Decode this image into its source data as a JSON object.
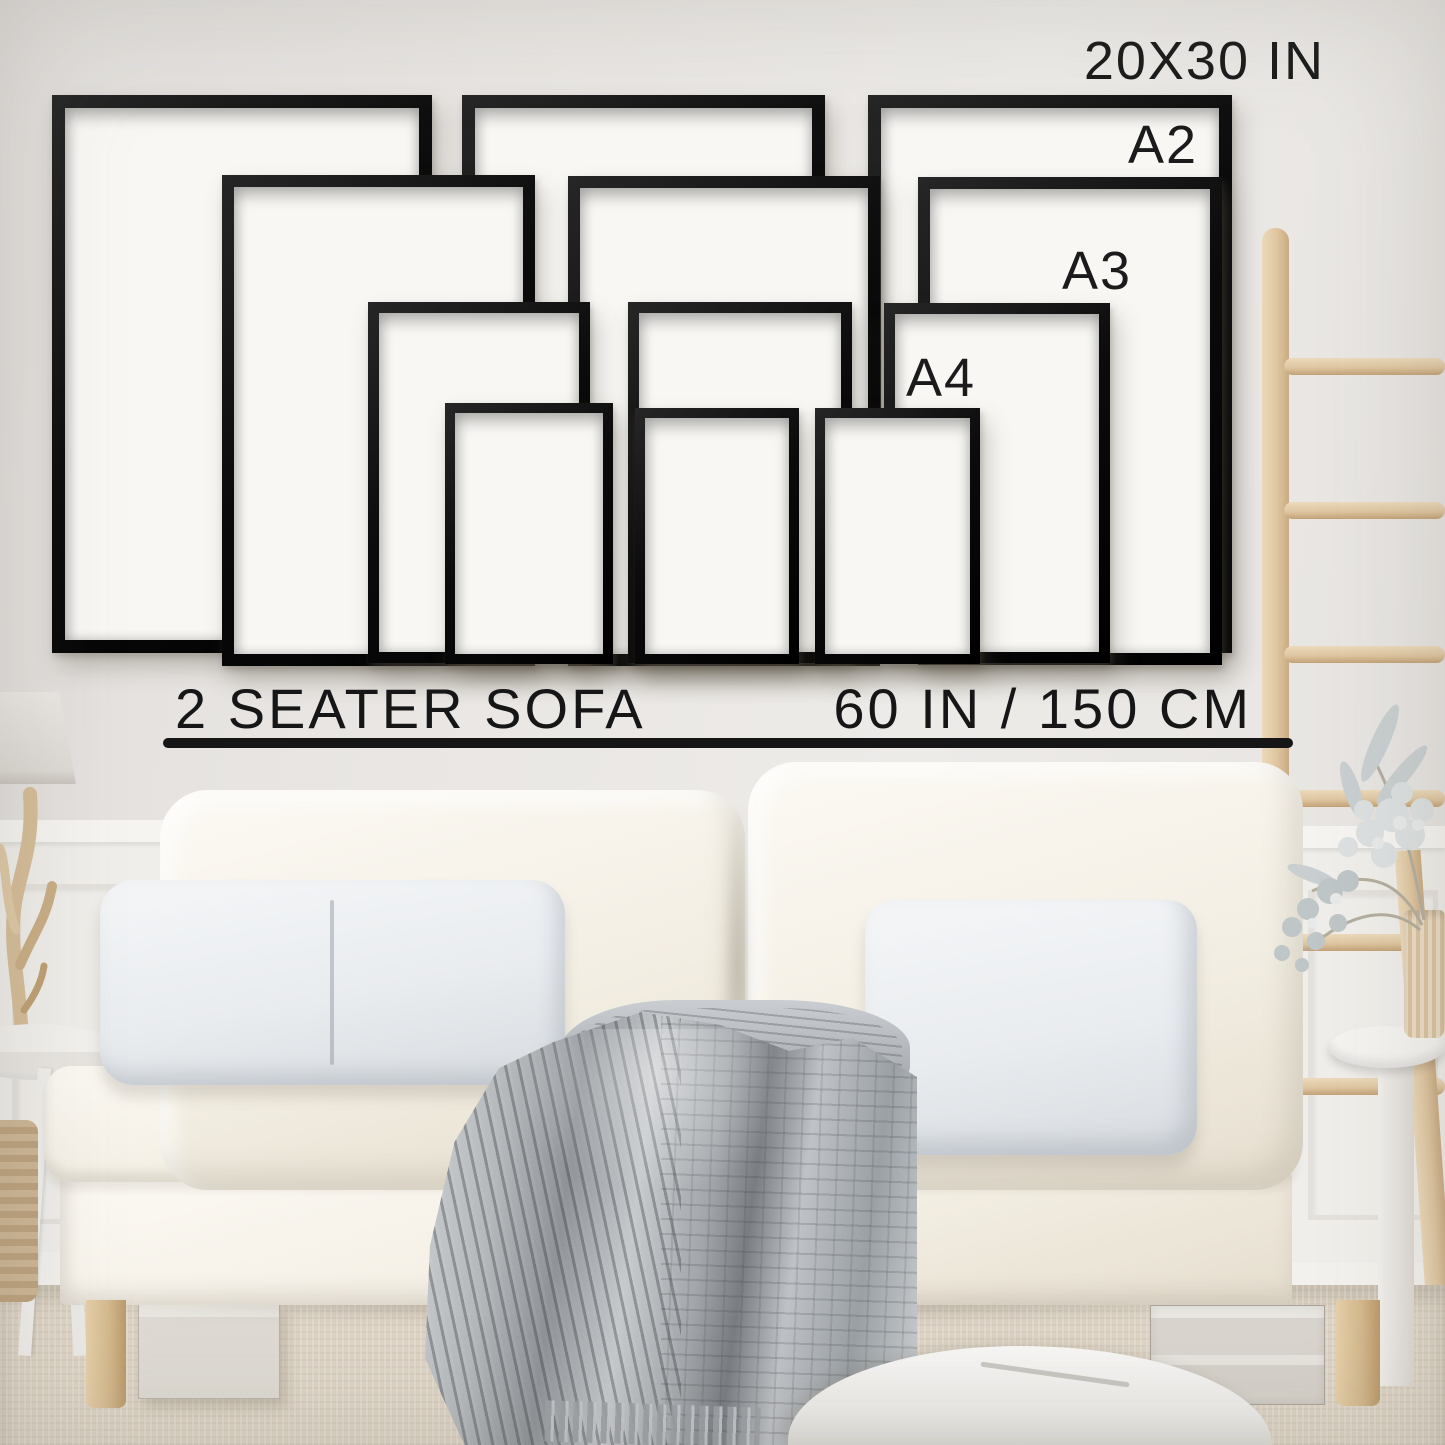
{
  "frame_size_guide": {
    "top_size_label": "20X30 IN",
    "size_labels": {
      "a2": "A2",
      "a3": "A3",
      "a4": "A4"
    },
    "frame_sizes_shown": [
      "20X30 IN",
      "A2",
      "A3",
      "A4"
    ]
  },
  "sofa_scale": {
    "sofa_type_label": "2 SEATER SOFA",
    "sofa_width_label": "60 IN / 150 CM"
  },
  "palette": {
    "frame_black": "#111111",
    "text_black": "#1b1b1b",
    "wall_gray": "#e9e6e3",
    "mat_white": "#f8f7f4",
    "sofa_cream": "#f5f1ea",
    "pillow_cool_white": "#eceef1",
    "blanket_gray": "#aeb2b6",
    "ladder_wood": "#e0cba7",
    "carpet_beige": "#ddd4c5"
  }
}
